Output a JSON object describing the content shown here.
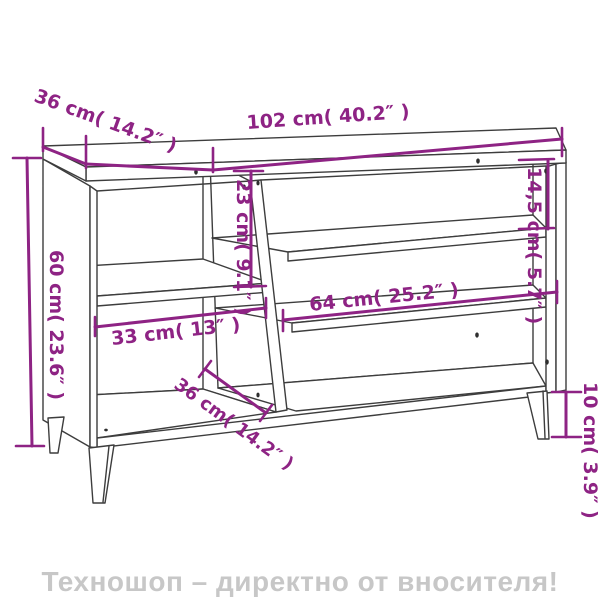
{
  "diagram": {
    "kind": "furniture-dimension-line-drawing",
    "dimensions": {
      "top_depth": "36 cm( 14.2″ )",
      "width": "102 cm( 40.2″ )",
      "left_upper_height": "23 cm( 9.1″ )",
      "right_gap_height": "14,5 cm( 5.7″ )",
      "overall_height": "60 cm( 23.6″ )",
      "inner_width": "64 cm( 25.2″ )",
      "left_width": "33 cm( 13″ )",
      "bottom_depth": "36 cm( 14.2″ )",
      "leg_height": "10 cm( 3.9″ )"
    }
  },
  "banner": {
    "text": "Техношоп – директно от вносителя!"
  },
  "colors": {
    "dimension_accent": "#8E2384",
    "drawing_line": "#3D3D3D",
    "banner_text": "#C7C7C7",
    "background": "#FFFFFF"
  }
}
